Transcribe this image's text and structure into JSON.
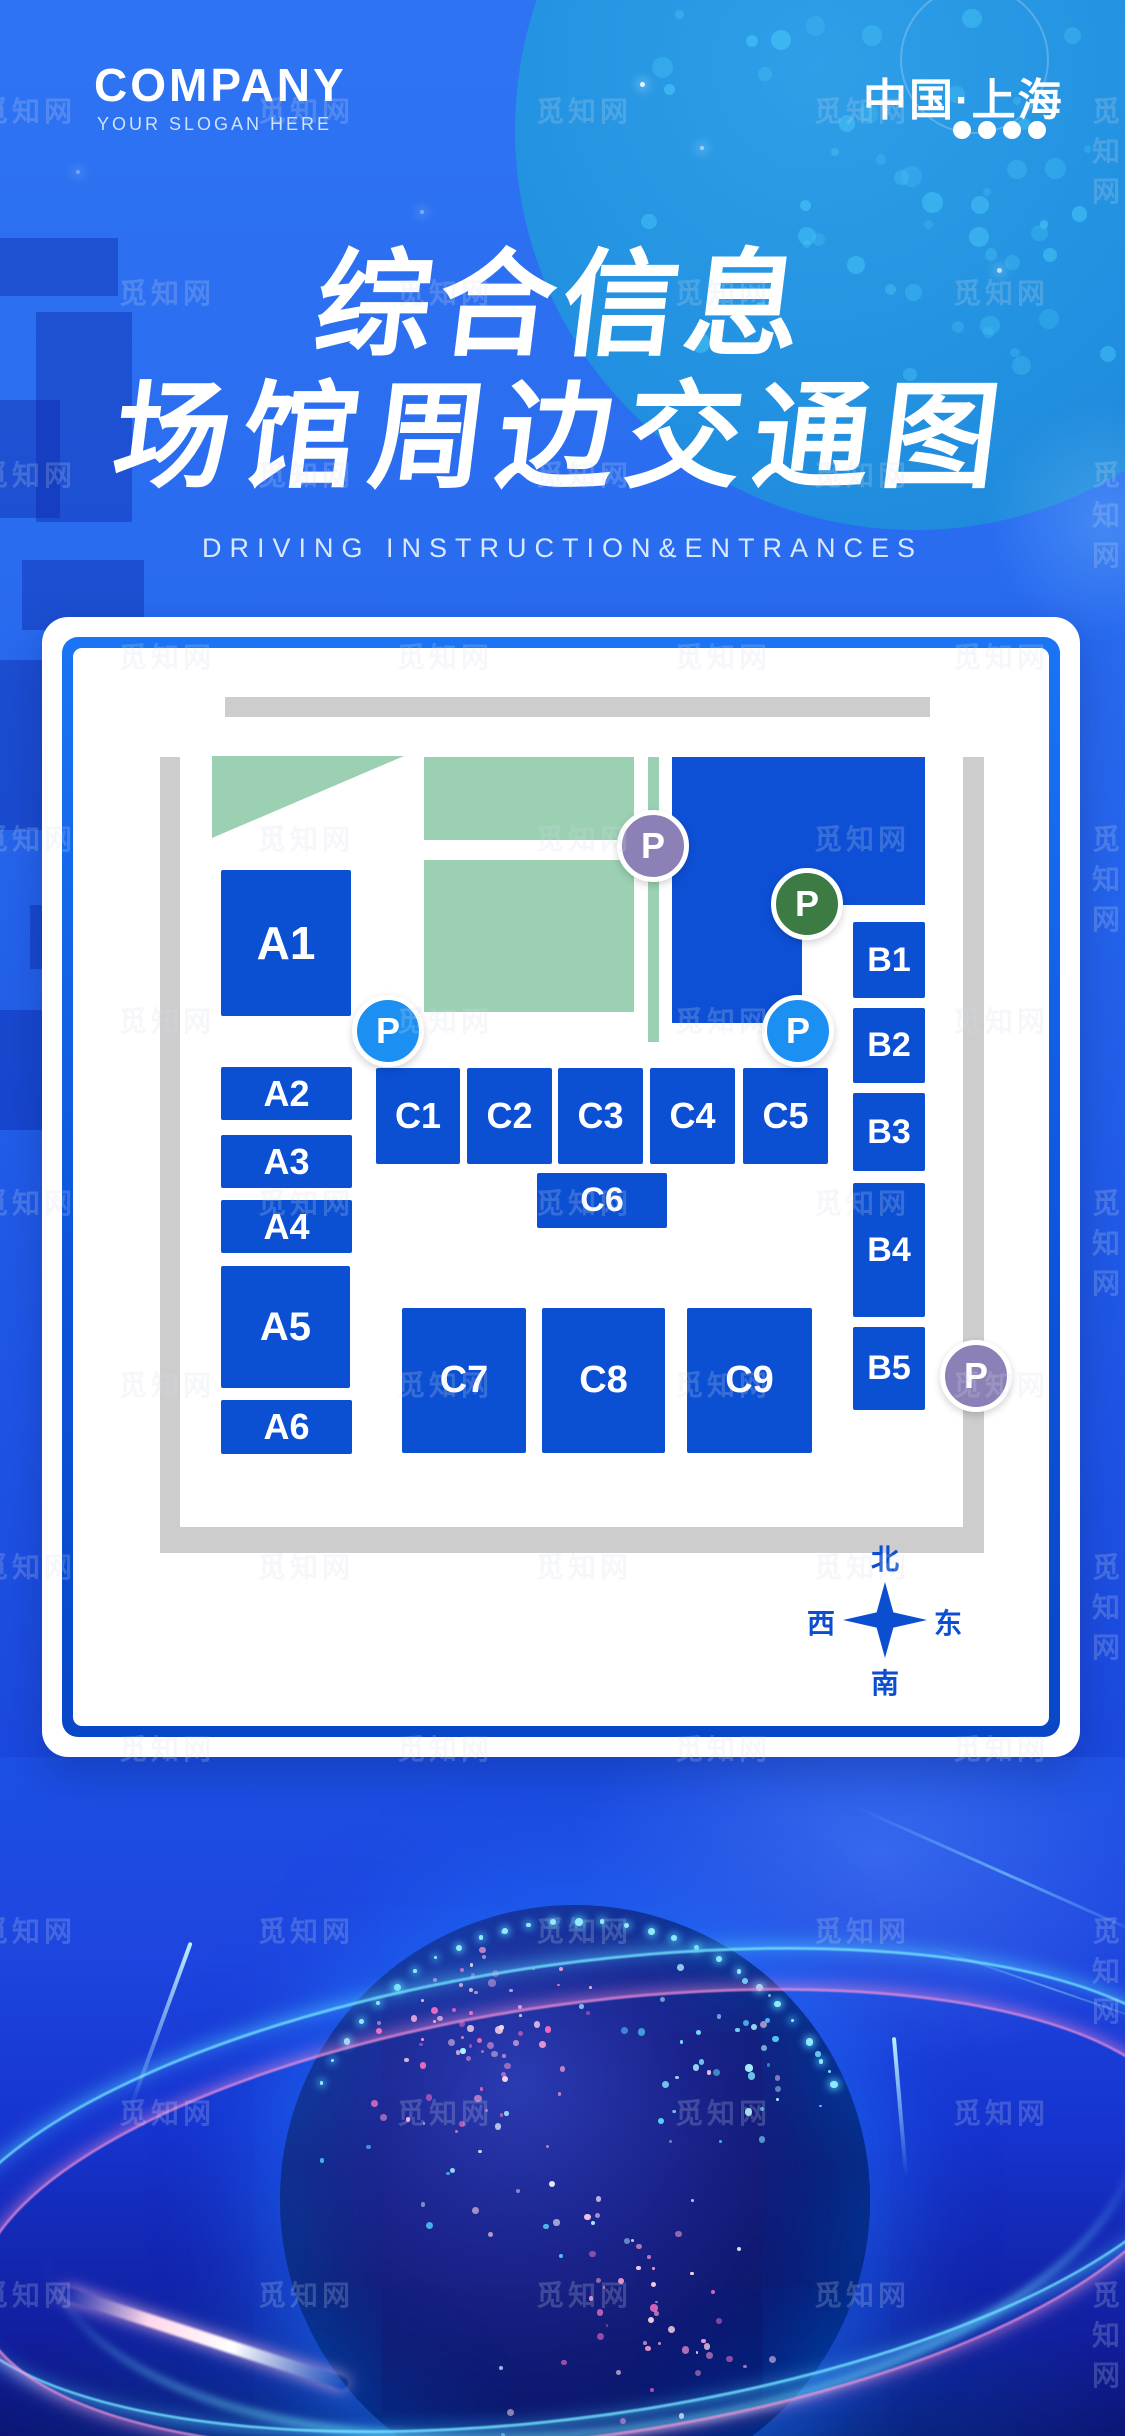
{
  "header": {
    "company": "COMPANY",
    "slogan": "YOUR SLOGAN HERE",
    "location": "中国·上海"
  },
  "title": {
    "line1": "综合信息",
    "line2": "场馆周边交通图",
    "subtitle": "DRIVING INSTRUCTION&ENTRANCES"
  },
  "map": {
    "blocks": [
      {
        "label": "A1"
      },
      {
        "label": "A2"
      },
      {
        "label": "A3"
      },
      {
        "label": "A4"
      },
      {
        "label": "A5"
      },
      {
        "label": "A6"
      },
      {
        "label": "B1"
      },
      {
        "label": "B2"
      },
      {
        "label": "B3"
      },
      {
        "label": "B4"
      },
      {
        "label": "B5"
      },
      {
        "label": "C1"
      },
      {
        "label": "C2"
      },
      {
        "label": "C3"
      },
      {
        "label": "C4"
      },
      {
        "label": "C5"
      },
      {
        "label": "C6"
      },
      {
        "label": "C7"
      },
      {
        "label": "C8"
      },
      {
        "label": "C9"
      }
    ],
    "parking": [
      {
        "label": "P",
        "color": "#8c80b6"
      },
      {
        "label": "P",
        "color": "#3c7b44"
      },
      {
        "label": "P",
        "color": "#1b8ff2"
      },
      {
        "label": "P",
        "color": "#1b8ff2"
      },
      {
        "label": "P",
        "color": "#8c80b6"
      }
    ],
    "compass": {
      "north": "北",
      "south": "南",
      "east": "东",
      "west": "西"
    },
    "legend_colors": {
      "building": "#0b4fd3",
      "green_area": "#9bd1b2",
      "road": "#cdcdcd"
    }
  },
  "watermark": {
    "text": "觅知网"
  },
  "colors": {
    "background_blue": "#215ee9",
    "light_circle_blue": "#1f82d8",
    "card_border_blue": "#0d55dd",
    "compass_blue": "#0b4fd0"
  }
}
